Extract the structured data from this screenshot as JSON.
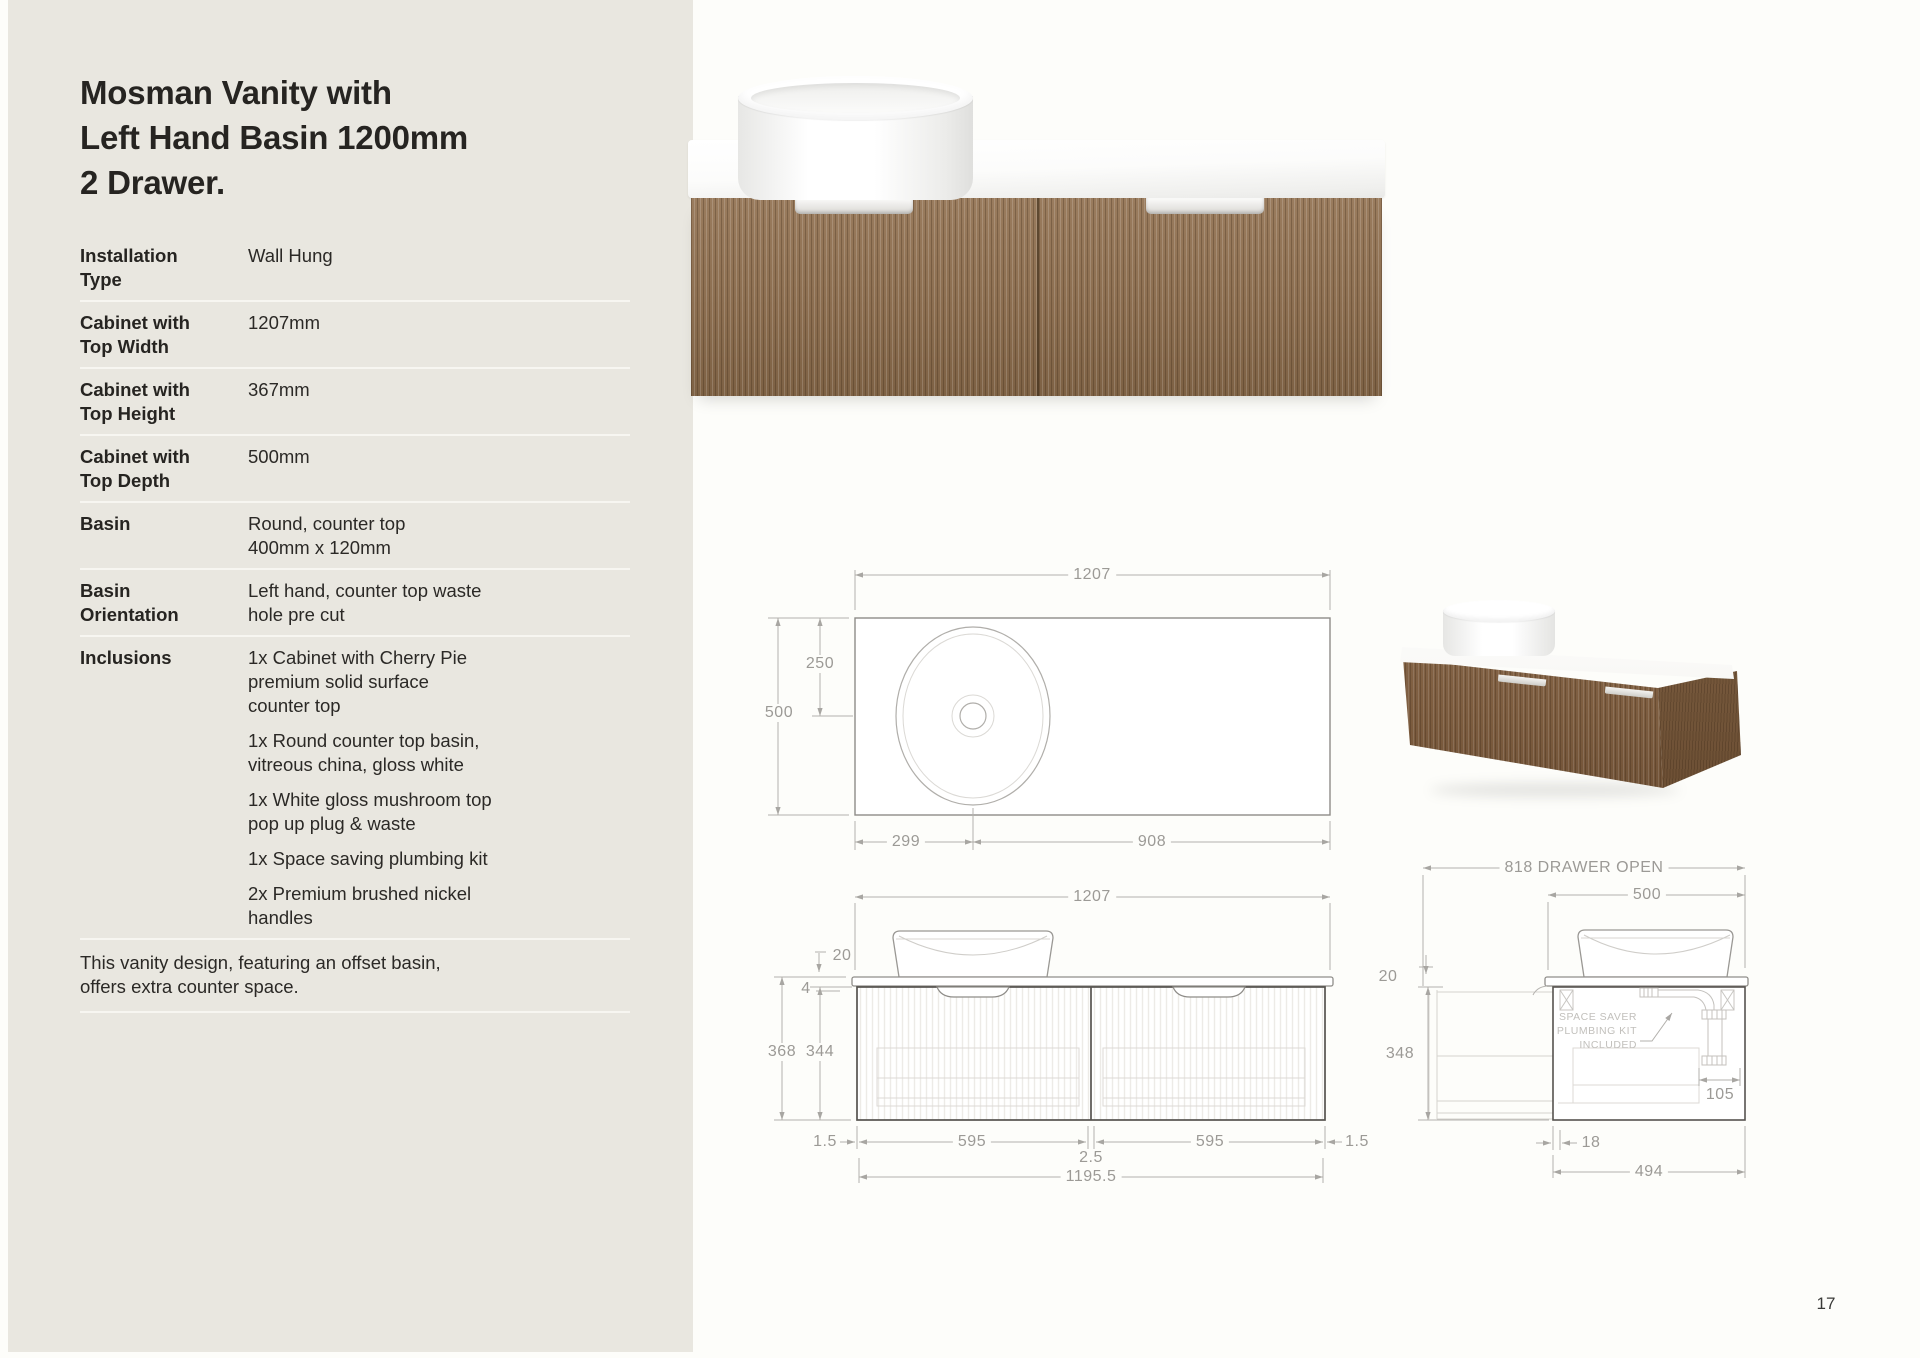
{
  "page": {
    "number": "17"
  },
  "sidebar": {
    "title": "Mosman Vanity with\nLeft Hand Basin 1200mm\n2 Drawer.",
    "specs": [
      {
        "label": "Installation\nType",
        "value": "Wall Hung"
      },
      {
        "label": "Cabinet with\nTop Width",
        "value": "1207mm"
      },
      {
        "label": "Cabinet with\nTop Height",
        "value": "367mm"
      },
      {
        "label": "Cabinet with\nTop Depth",
        "value": "500mm"
      },
      {
        "label": "Basin",
        "value": "Round, counter top\n400mm x 120mm"
      },
      {
        "label": "Basin\nOrientation",
        "value": "Left hand, counter top waste\nhole pre cut"
      }
    ],
    "inclusions_label": "Inclusions",
    "inclusions": [
      "1x Cabinet with Cherry Pie\npremium solid surface\ncounter top",
      "1x Round counter top basin,\nvitreous china, gloss white",
      "1x White gloss mushroom top\npop up plug & waste",
      "1x Space saving plumbing kit",
      "2x Premium brushed nickel\nhandles"
    ],
    "note": "This vanity design, featuring an offset basin,\noffers extra counter space."
  },
  "drawings": {
    "plan": {
      "width": "1207",
      "basin_offset": "250",
      "depth": "500",
      "basin_left": "299",
      "basin_right": "908"
    },
    "front": {
      "width": "1207",
      "counter_thickness": "20",
      "top_gap": "4",
      "total_height": "368",
      "cabinet_height": "344",
      "edge_left": "1.5",
      "drawer_left": "595",
      "center_gap": "2.5",
      "drawer_right": "595",
      "edge_right": "1.5",
      "inner_width": "1195.5"
    },
    "side": {
      "drawer_open": "818 DRAWER OPEN",
      "depth": "500",
      "counter_thickness": "20",
      "cabinet_height": "348",
      "plumbing_note": "SPACE SAVER\nPLUMBING KIT\nINCLUDED",
      "plumbing_pocket": "105",
      "front_offset": "18",
      "cabinet_depth": "494"
    }
  }
}
